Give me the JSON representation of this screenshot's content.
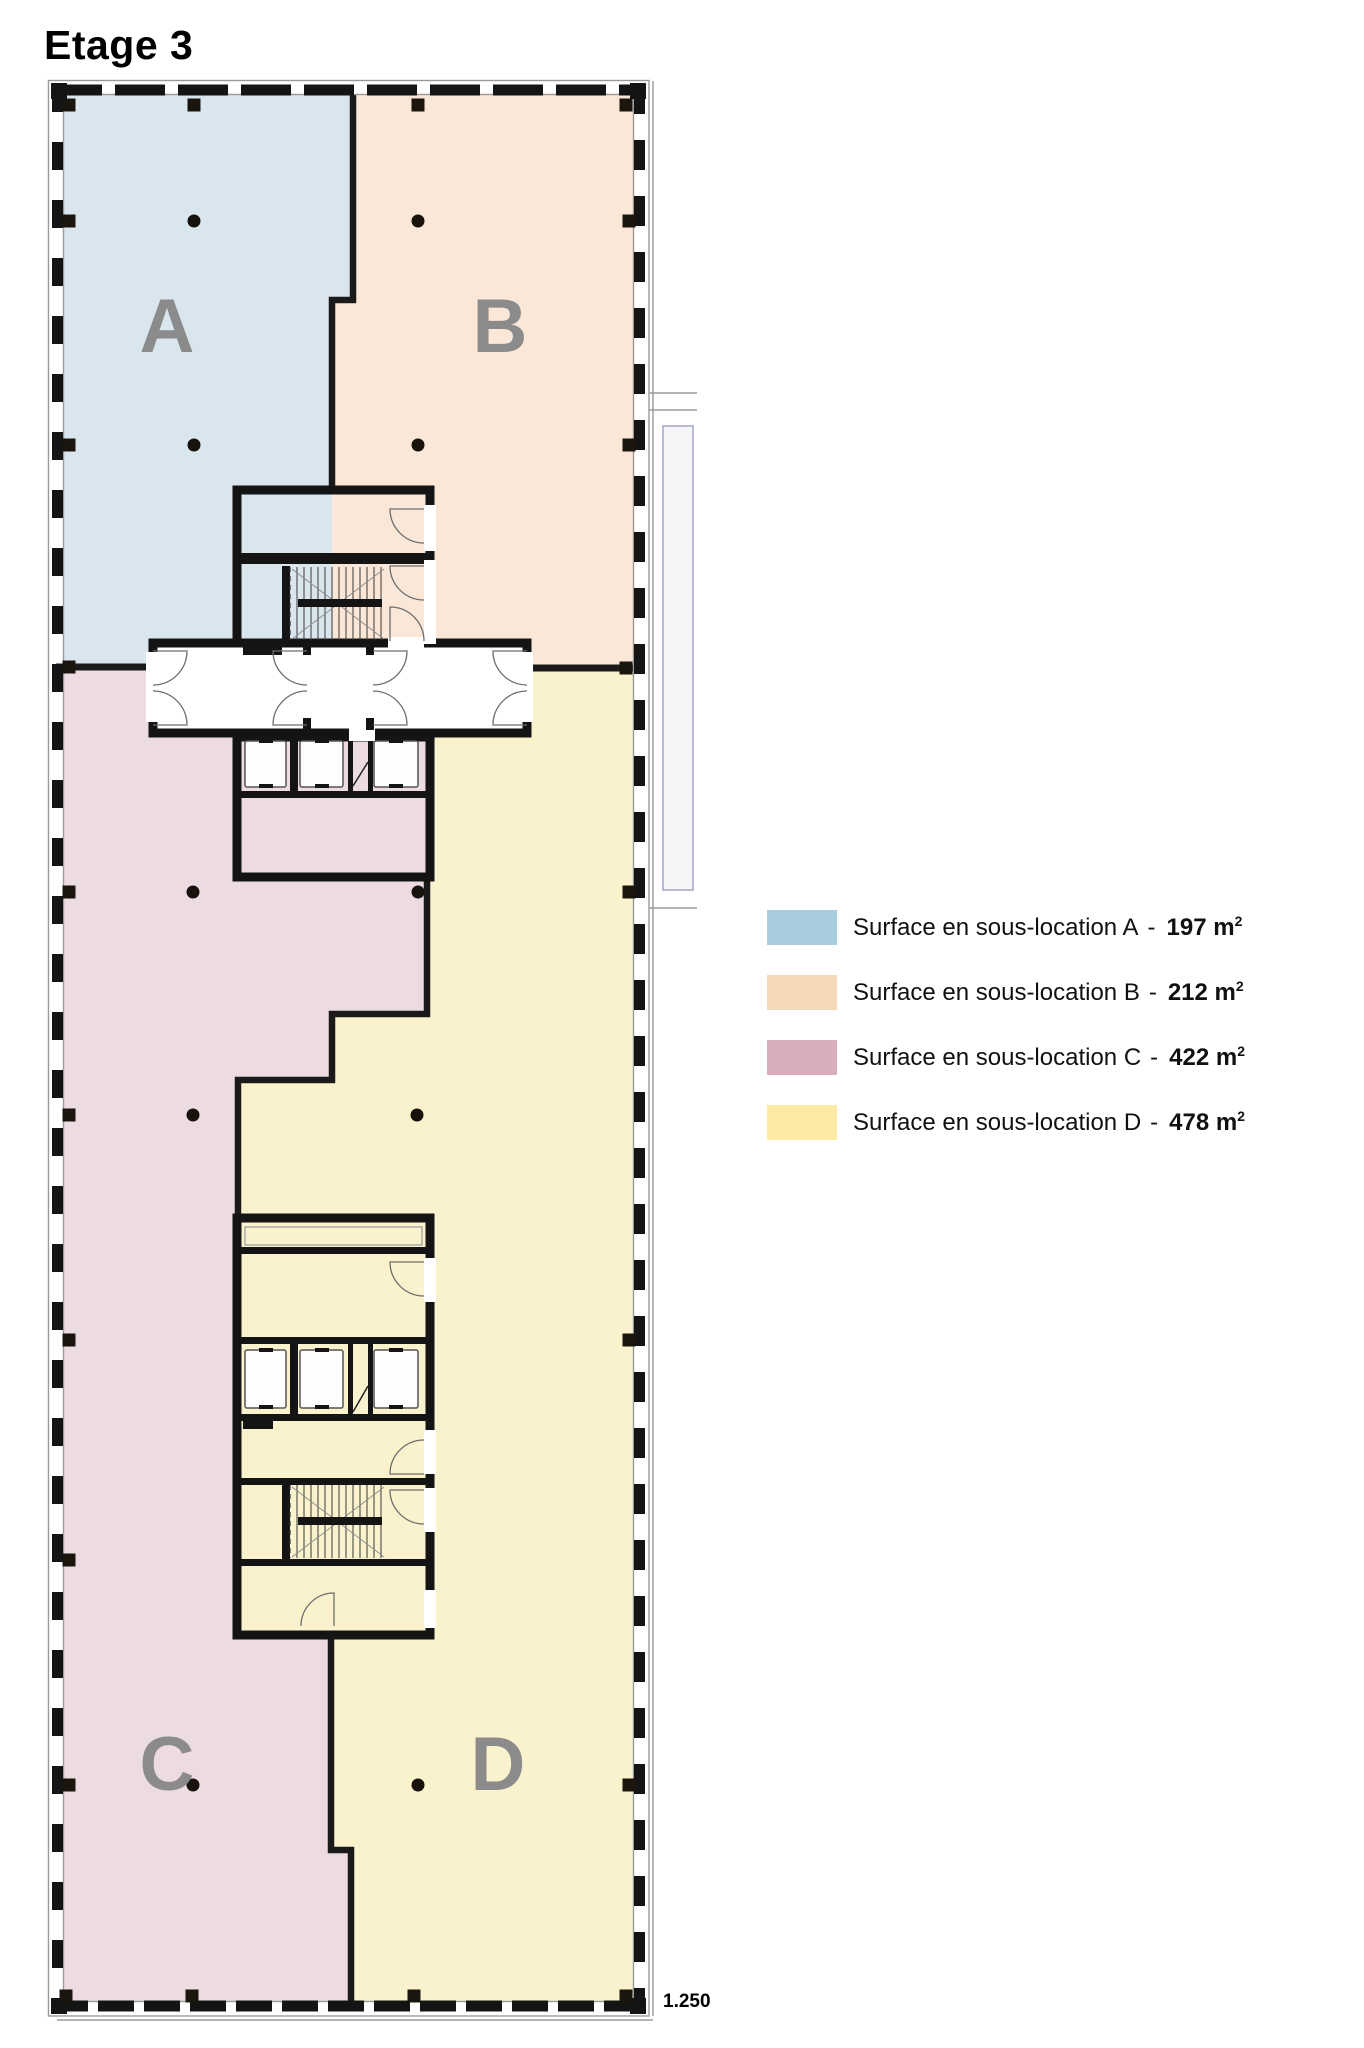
{
  "title": "Etage 3",
  "scale_label": "1.250",
  "zones": {
    "a": {
      "label": "A",
      "fill": "#d9e6ee"
    },
    "b": {
      "label": "B",
      "fill": "#fae7d7"
    },
    "c": {
      "label": "C",
      "fill": "#ecdce2"
    },
    "d": {
      "label": "D",
      "fill": "#faf2cd"
    }
  },
  "legend": {
    "rows": [
      {
        "zone": "A",
        "color": "#a9cddf",
        "label": "Surface en sous-location A",
        "sep": "-",
        "value": "197",
        "unit": "m",
        "exponent": "2"
      },
      {
        "zone": "B",
        "color": "#f5d8b8",
        "label": "Surface en sous-location B",
        "sep": "-",
        "value": "212",
        "unit": "m",
        "exponent": "2"
      },
      {
        "zone": "C",
        "color": "#d8aebc",
        "label": "Surface en sous-location C",
        "sep": "-",
        "value": "422",
        "unit": "m",
        "exponent": "2"
      },
      {
        "zone": "D",
        "color": "#fdeba4",
        "label": "Surface en sous-location D",
        "sep": "-",
        "value": "478",
        "unit": "m",
        "exponent": "2"
      }
    ]
  }
}
